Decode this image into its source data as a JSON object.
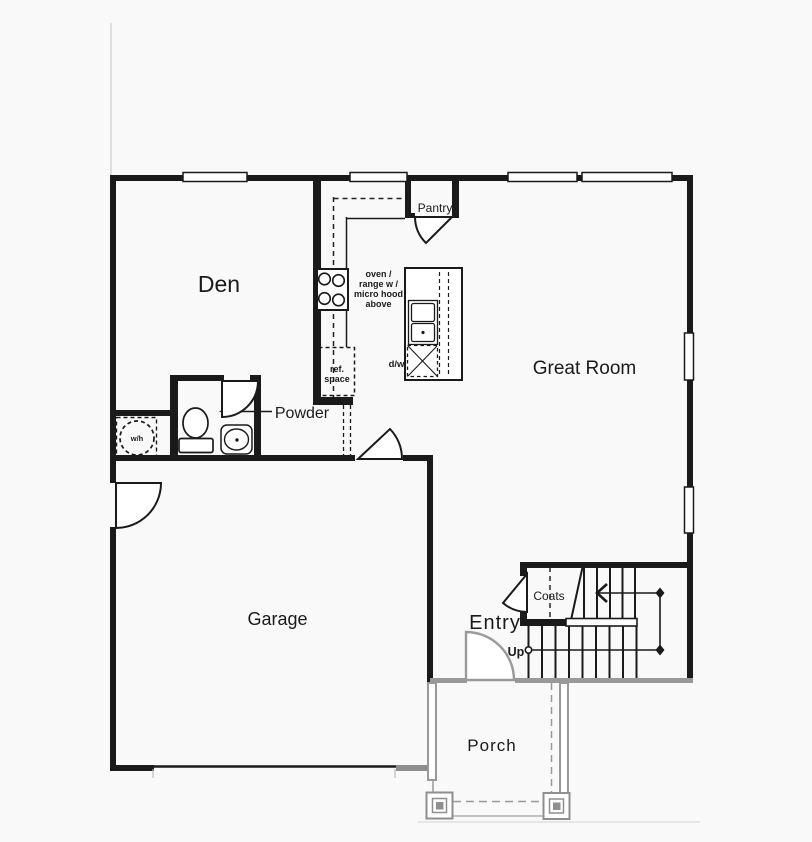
{
  "plan": {
    "rooms": {
      "den": "Den",
      "great_room": "Great Room",
      "garage": "Garage",
      "entry": "Entry",
      "porch": "Porch",
      "powder": "Powder",
      "pantry": "Pantry",
      "coats": "Coats"
    },
    "annotations": {
      "up": "Up",
      "water_heater": "w/h",
      "dishwasher": "d/w",
      "oven_line1": "oven /",
      "oven_line2": "range w /",
      "oven_line3": "micro hood",
      "oven_line4": "above",
      "ref_line1": "ref.",
      "ref_line2": "space"
    },
    "colors": {
      "wall": "#1a1a1a",
      "porch_gray": "#999999",
      "background": "#f9f9f9"
    }
  }
}
